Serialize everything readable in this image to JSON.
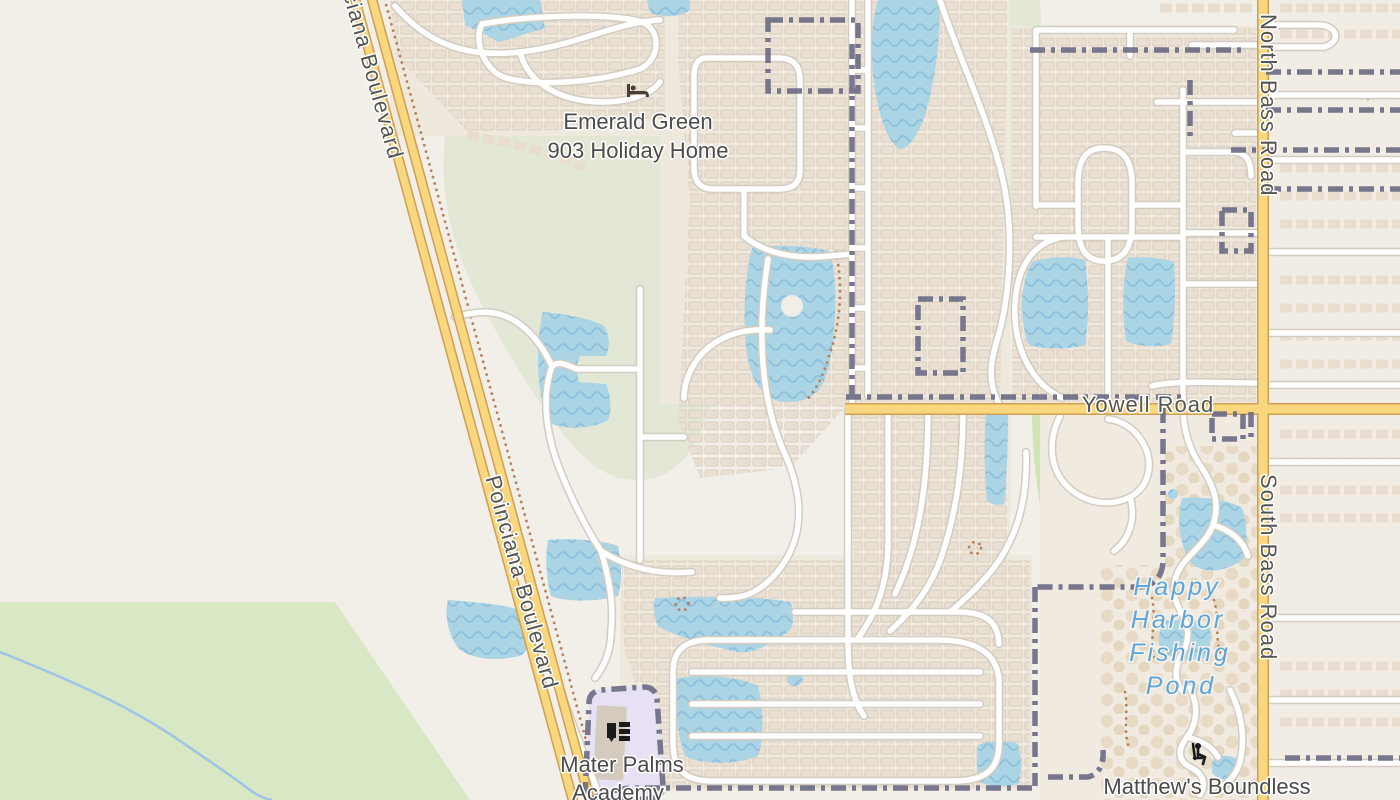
{
  "map_type": "street-map-tile-view",
  "labels": {
    "emerald_green": {
      "line1": "Emerald Green",
      "line2": "903 Holiday Home"
    },
    "mater_palms": {
      "line1": "Mater Palms",
      "line2": "Academy"
    },
    "matthews_boundless": "Matthew's Boundless",
    "happy_harbor": {
      "line1": "Happy",
      "line2": "Harbor",
      "line3": "Fishing",
      "line4": "Pond"
    }
  },
  "roads": {
    "poinciana_top": "Poinciana Boulevard",
    "poinciana_mid": "Poinciana Boulevard",
    "yowell": "Yowell Road",
    "north_bass": "North Bass Road",
    "south_bass": "South Bass Road"
  },
  "icons": {
    "lodging": "bed-icon",
    "school": "school-icon",
    "playground": "playground-icon"
  },
  "colors": {
    "background": "#f2efe9",
    "water": "#abd4e4",
    "water_wave": "#8cc0dc",
    "road_primary_fill": "#f8d77e",
    "road_primary_casing": "#cf9f52",
    "road_minor_fill": "#ffffff",
    "road_minor_casing": "#d2ccc1",
    "boundary": "#6d6d85",
    "grass": "#d8e8c5",
    "park": "#cfe5b3",
    "sage": "#e3e8d6",
    "forest": "#a8cf92",
    "building": "#e9dfd2",
    "school_area": "#e7e1f3",
    "label_text": "#4b4b4b",
    "water_label_text": "#5ea5db",
    "dotted_path": "#b5825c"
  }
}
